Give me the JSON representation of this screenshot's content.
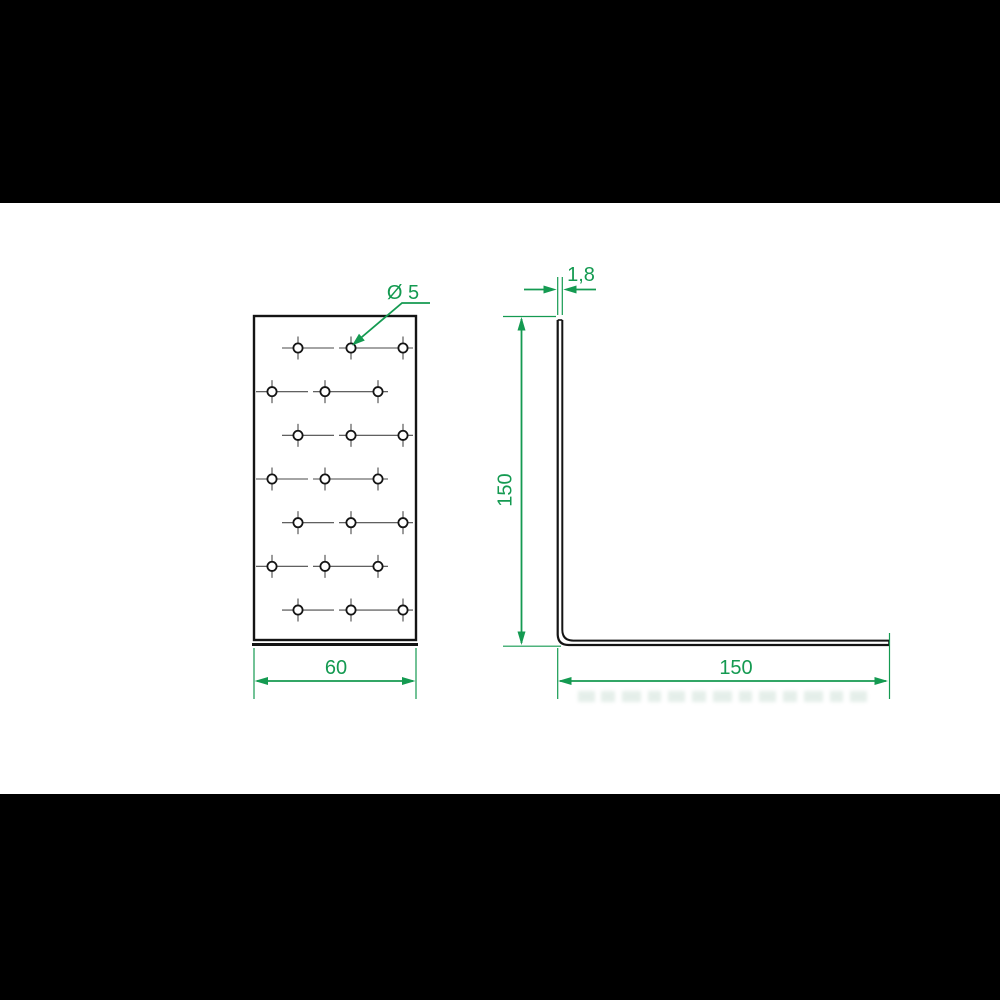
{
  "drawing": {
    "accent_color": "#149a51",
    "outline_color": "#141414",
    "centerline_color": "#4a4a4a",
    "front_view": {
      "hole_diameter_label": "Ø 5",
      "width_label": "60",
      "hole_rows": 7,
      "holes_per_row": 3
    },
    "side_view": {
      "thickness_label": "1,8",
      "height_label": "150",
      "length_label": "150"
    }
  }
}
